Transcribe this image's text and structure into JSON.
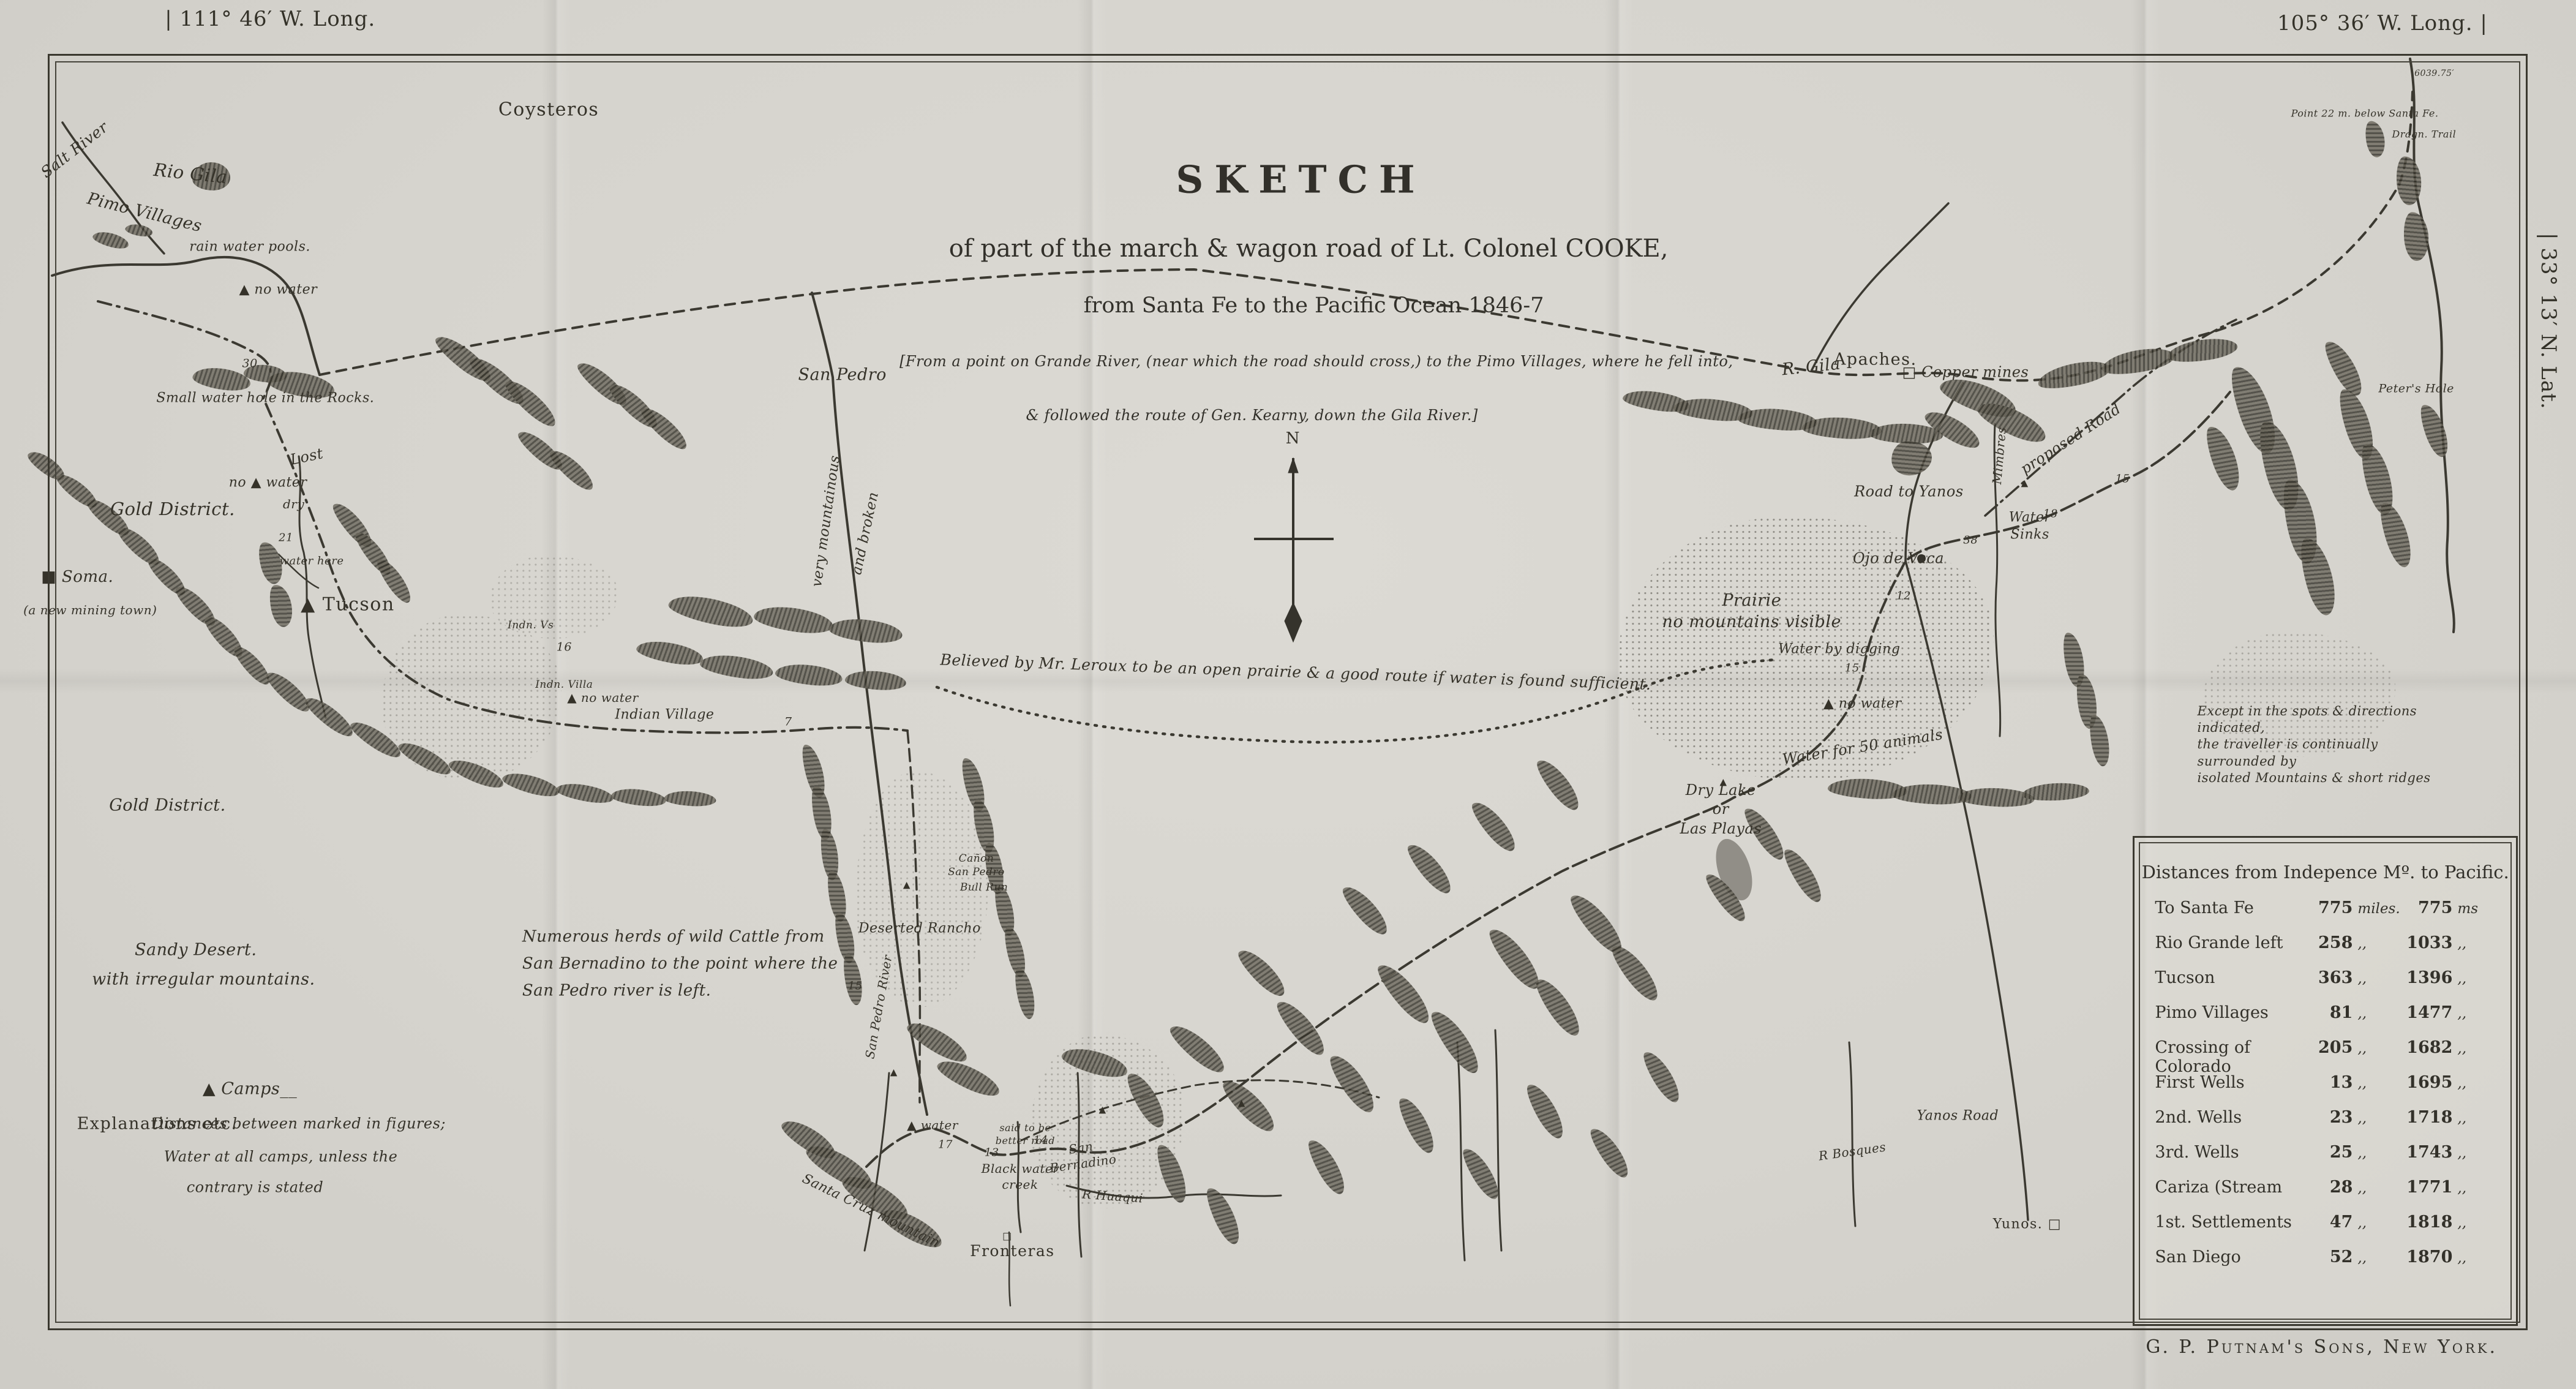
{
  "margins": {
    "long_left": "| 111° 46′ W. Long.",
    "long_right": "105° 36′ W. Long. |",
    "lat_right": "| 33° 13′ N. Lat.",
    "publisher": "G. P. Putnam's Sons, New York."
  },
  "title_block": {
    "title": "SKETCH",
    "line2": "of part of the march & wagon road of Lt. Colonel COOKE,",
    "line3": "from Santa Fe to the Pacific Ocean 1846-7",
    "line4": "[From a point on Grande River, (near which the road should cross,) to the Pimo Villages, where he fell into,",
    "line5": "& followed the route of Gen. Kearny, down the Gila River.]"
  },
  "distances_table": {
    "title": "Distances from Indepence Mº. to Pacific.",
    "rows": [
      {
        "place": "To Santa Fe",
        "d": "775",
        "du": "miles.",
        "t": "775",
        "tu": "ms"
      },
      {
        "place": "Rio Grande left",
        "d": "258",
        "du": ",,",
        "t": "1033",
        "tu": ",,"
      },
      {
        "place": "Tucson",
        "d": "363",
        "du": ",,",
        "t": "1396",
        "tu": ",,"
      },
      {
        "place": "Pimo Villages",
        "d": "81",
        "du": ",,",
        "t": "1477",
        "tu": ",,"
      },
      {
        "place": "Crossing of Colorado",
        "d": "205",
        "du": ",,",
        "t": "1682",
        "tu": ",,"
      },
      {
        "place": "First Wells",
        "d": "13",
        "du": ",,",
        "t": "1695",
        "tu": ",,"
      },
      {
        "place": "2nd. Wells",
        "d": "23",
        "du": ",,",
        "t": "1718",
        "tu": ",,"
      },
      {
        "place": "3rd. Wells",
        "d": "25",
        "du": ",,",
        "t": "1743",
        "tu": ",,"
      },
      {
        "place": "Cariza (Stream",
        "d": "28",
        "du": ",,",
        "t": "1771",
        "tu": ",,"
      },
      {
        "place": "1st. Settlements",
        "d": "47",
        "du": ",,",
        "t": "1818",
        "tu": ",,"
      },
      {
        "place": "San Diego",
        "d": "52",
        "du": ",,",
        "t": "1870",
        "tu": ",,"
      }
    ]
  },
  "map_labels": [
    {
      "t": "Coysteros",
      "x": 21.3,
      "y": 7.9,
      "fs": 30,
      "c": "p"
    },
    {
      "t": "Salt River",
      "x": 2.9,
      "y": 10.8,
      "fs": 25,
      "r": -38
    },
    {
      "t": "Pimo Villages",
      "x": 5.6,
      "y": 15.3,
      "fs": 27,
      "r": 14
    },
    {
      "t": "Rio Gila",
      "x": 7.4,
      "y": 12.5,
      "fs": 29,
      "r": 6
    },
    {
      "t": "rain water pools.",
      "x": 9.7,
      "y": 17.8,
      "fs": 22
    },
    {
      "t": "▲ no water",
      "x": 10.8,
      "y": 20.9,
      "fs": 22
    },
    {
      "t": "30",
      "x": 9.7,
      "y": 26.2,
      "fs": 19,
      "c": "n"
    },
    {
      "t": "Small water  hole in the Rocks.",
      "x": 10.3,
      "y": 28.7,
      "fs": 22
    },
    {
      "t": "Gold District.",
      "x": 6.7,
      "y": 36.7,
      "fs": 29
    },
    {
      "t": "■ Soma.",
      "x": 3.0,
      "y": 41.6,
      "fs": 26
    },
    {
      "t": "(a new mining town)",
      "x": 3.5,
      "y": 43.9,
      "fs": 20
    },
    {
      "t": "Lost",
      "x": 11.9,
      "y": 32.9,
      "fs": 24,
      "r": -12
    },
    {
      "t": "no ▲ water",
      "x": 10.4,
      "y": 34.8,
      "fs": 22
    },
    {
      "t": "dry",
      "x": 11.4,
      "y": 36.3,
      "fs": 20
    },
    {
      "t": "21",
      "x": 11.1,
      "y": 38.7,
      "fs": 18,
      "c": "n"
    },
    {
      "t": "water here",
      "x": 12.1,
      "y": 40.4,
      "fs": 18
    },
    {
      "t": "▲ Tucson",
      "x": 13.5,
      "y": 43.5,
      "fs": 30,
      "c": "p"
    },
    {
      "t": "Indn. Vs",
      "x": 20.6,
      "y": 45.0,
      "fs": 17
    },
    {
      "t": "16",
      "x": 21.9,
      "y": 46.6,
      "fs": 19,
      "c": "n"
    },
    {
      "t": "Indn. Villa",
      "x": 21.9,
      "y": 49.3,
      "fs": 17
    },
    {
      "t": "▲ no water",
      "x": 23.4,
      "y": 50.2,
      "fs": 20
    },
    {
      "t": "Indian Village",
      "x": 25.8,
      "y": 51.5,
      "fs": 22
    },
    {
      "t": "7",
      "x": 30.6,
      "y": 52.0,
      "fs": 19,
      "c": "n"
    },
    {
      "t": "San  Pedro",
      "x": 32.7,
      "y": 27.0,
      "fs": 27
    },
    {
      "t": "very mountainous",
      "x": 32.1,
      "y": 37.5,
      "fs": 23,
      "r": -82
    },
    {
      "t": "and broken",
      "x": 33.6,
      "y": 38.4,
      "fs": 23,
      "r": -78
    },
    {
      "t": "Believed by Mr. Leroux to be an open prairie & a good route if water is found sufficient.",
      "x": 50.3,
      "y": 48.4,
      "fs": 25,
      "r": 2
    },
    {
      "t": "R. Gila",
      "x": 70.3,
      "y": 26.4,
      "fs": 27,
      "r": -6
    },
    {
      "t": "Apaches.",
      "x": 72.8,
      "y": 25.9,
      "fs": 27,
      "c": "p"
    },
    {
      "t": "□ Copper mines",
      "x": 76.3,
      "y": 26.8,
      "fs": 24
    },
    {
      "t": "Peter's Hole",
      "x": 93.8,
      "y": 28.0,
      "fs": 19
    },
    {
      "t": "Point 22 m. below Santa Fe.",
      "x": 91.8,
      "y": 8.2,
      "fs": 16
    },
    {
      "t": "Dragn. Trail",
      "x": 94.1,
      "y": 9.7,
      "fs": 16
    },
    {
      "t": "6039.75′",
      "x": 94.5,
      "y": 5.3,
      "fs": 14,
      "c": "n"
    },
    {
      "t": "proposed Road",
      "x": 80.4,
      "y": 31.6,
      "fs": 24,
      "r": -33
    },
    {
      "t": "Road  to  Yanos",
      "x": 74.1,
      "y": 35.4,
      "fs": 24
    },
    {
      "t": "Mimbres",
      "x": 77.6,
      "y": 32.8,
      "fs": 20,
      "r": -85
    },
    {
      "t": "15",
      "x": 82.4,
      "y": 34.5,
      "fs": 18,
      "c": "n"
    },
    {
      "t": "18",
      "x": 79.6,
      "y": 37.0,
      "fs": 18,
      "c": "n"
    },
    {
      "t": "Water\nSinks",
      "x": 78.8,
      "y": 37.9,
      "fs": 22
    },
    {
      "t": "38",
      "x": 76.5,
      "y": 38.9,
      "fs": 18,
      "c": "n"
    },
    {
      "t": "Ojo de Vaca",
      "x": 73.7,
      "y": 40.2,
      "fs": 24
    },
    {
      "t": "Prairie\nno mountains visible",
      "x": 68.0,
      "y": 44.0,
      "fs": 27
    },
    {
      "t": "Water by digging",
      "x": 71.4,
      "y": 46.8,
      "fs": 22
    },
    {
      "t": "15",
      "x": 71.9,
      "y": 48.1,
      "fs": 18,
      "c": "n"
    },
    {
      "t": "▲ no water",
      "x": 72.3,
      "y": 50.7,
      "fs": 22
    },
    {
      "t": "12",
      "x": 73.9,
      "y": 42.9,
      "fs": 18,
      "c": "n"
    },
    {
      "t": "Water for 50 animals",
      "x": 72.3,
      "y": 53.8,
      "fs": 24,
      "r": -9
    },
    {
      "t": "Dry Lake\nor\nLas Playas",
      "x": 66.8,
      "y": 58.3,
      "fs": 24
    },
    {
      "t": "Except in the spots & directions indicated,\nthe traveller is continually surrounded by\nisolated Mountains & short ridges",
      "x": 90.2,
      "y": 53.6,
      "fs": 21,
      "al": "left"
    },
    {
      "t": "Numerous herds of wild Cattle from\nSan Bernadino to the point where the\nSan Pedro river is left.",
      "x": 26.4,
      "y": 69.4,
      "fs": 26,
      "al": "left",
      "lh": 1.7
    },
    {
      "t": "Cañon\nSan Pedro",
      "x": 37.9,
      "y": 62.3,
      "fs": 17
    },
    {
      "t": "Bull Run",
      "x": 38.2,
      "y": 63.9,
      "fs": 17
    },
    {
      "t": "Deserted Rancho",
      "x": 35.7,
      "y": 66.9,
      "fs": 22
    },
    {
      "t": "15",
      "x": 33.2,
      "y": 71.0,
      "fs": 18,
      "c": "n"
    },
    {
      "t": "San Pedro River",
      "x": 34.1,
      "y": 72.5,
      "fs": 20,
      "r": -80
    },
    {
      "t": "Santa Cruz mountain",
      "x": 33.8,
      "y": 87.2,
      "fs": 22,
      "r": 26
    },
    {
      "t": "▲ water",
      "x": 36.2,
      "y": 81.0,
      "fs": 20
    },
    {
      "t": "17",
      "x": 36.7,
      "y": 82.4,
      "fs": 18,
      "c": "n"
    },
    {
      "t": "13",
      "x": 38.5,
      "y": 83.0,
      "fs": 18,
      "c": "n"
    },
    {
      "t": "said to be\nbetter road",
      "x": 39.8,
      "y": 81.7,
      "fs": 16
    },
    {
      "t": "14",
      "x": 40.4,
      "y": 82.1,
      "fs": 18,
      "c": "n"
    },
    {
      "t": "Black water\ncreek",
      "x": 39.6,
      "y": 84.7,
      "fs": 20
    },
    {
      "t": "San\nBernadino",
      "x": 42.0,
      "y": 83.2,
      "fs": 20,
      "r": -8
    },
    {
      "t": "R Huaqui",
      "x": 43.2,
      "y": 86.1,
      "fs": 20,
      "r": 4
    },
    {
      "t": "□",
      "x": 39.1,
      "y": 89.0,
      "fs": 16,
      "c": "n"
    },
    {
      "t": "Fronteras",
      "x": 39.3,
      "y": 90.1,
      "fs": 25,
      "c": "p"
    },
    {
      "t": "R Bosques",
      "x": 71.9,
      "y": 82.9,
      "fs": 20,
      "r": -8
    },
    {
      "t": "Yanos Road",
      "x": 76.0,
      "y": 80.4,
      "fs": 22
    },
    {
      "t": "Yunos. □",
      "x": 78.7,
      "y": 88.2,
      "fs": 22,
      "c": "p"
    },
    {
      "t": "Gold District.",
      "x": 6.5,
      "y": 58.0,
      "fs": 27
    },
    {
      "t": "Sandy Desert.",
      "x": 7.6,
      "y": 68.4,
      "fs": 27
    },
    {
      "t": "with irregular mountains.",
      "x": 7.9,
      "y": 70.5,
      "fs": 27
    },
    {
      "t": "▲  Camps__",
      "x": 9.7,
      "y": 78.4,
      "fs": 27
    },
    {
      "t": "Explanations  etc.",
      "x": 6.1,
      "y": 80.9,
      "fs": 27,
      "c": "p"
    },
    {
      "t": "Distances between  marked in figures;",
      "x": 11.6,
      "y": 80.9,
      "fs": 24
    },
    {
      "t": "Water at all camps, unless the",
      "x": 10.9,
      "y": 83.3,
      "fs": 24
    },
    {
      "t": "contrary is stated",
      "x": 9.9,
      "y": 85.5,
      "fs": 24
    },
    {
      "t": "N",
      "x": 50.2,
      "y": 31.6,
      "fs": 26,
      "c": "p"
    },
    {
      "t": "▲",
      "x": 66.9,
      "y": 56.3,
      "fs": 15,
      "c": "n"
    },
    {
      "t": "▲",
      "x": 35.2,
      "y": 63.7,
      "fs": 15,
      "c": "n"
    },
    {
      "t": "▲",
      "x": 34.7,
      "y": 77.2,
      "fs": 15,
      "c": "n"
    },
    {
      "t": "▲",
      "x": 42.8,
      "y": 79.9,
      "fs": 15,
      "c": "n"
    },
    {
      "t": "▲",
      "x": 48.2,
      "y": 79.4,
      "fs": 15,
      "c": "n"
    },
    {
      "t": "▲",
      "x": 78.6,
      "y": 34.8,
      "fs": 15,
      "c": "n"
    }
  ]
}
